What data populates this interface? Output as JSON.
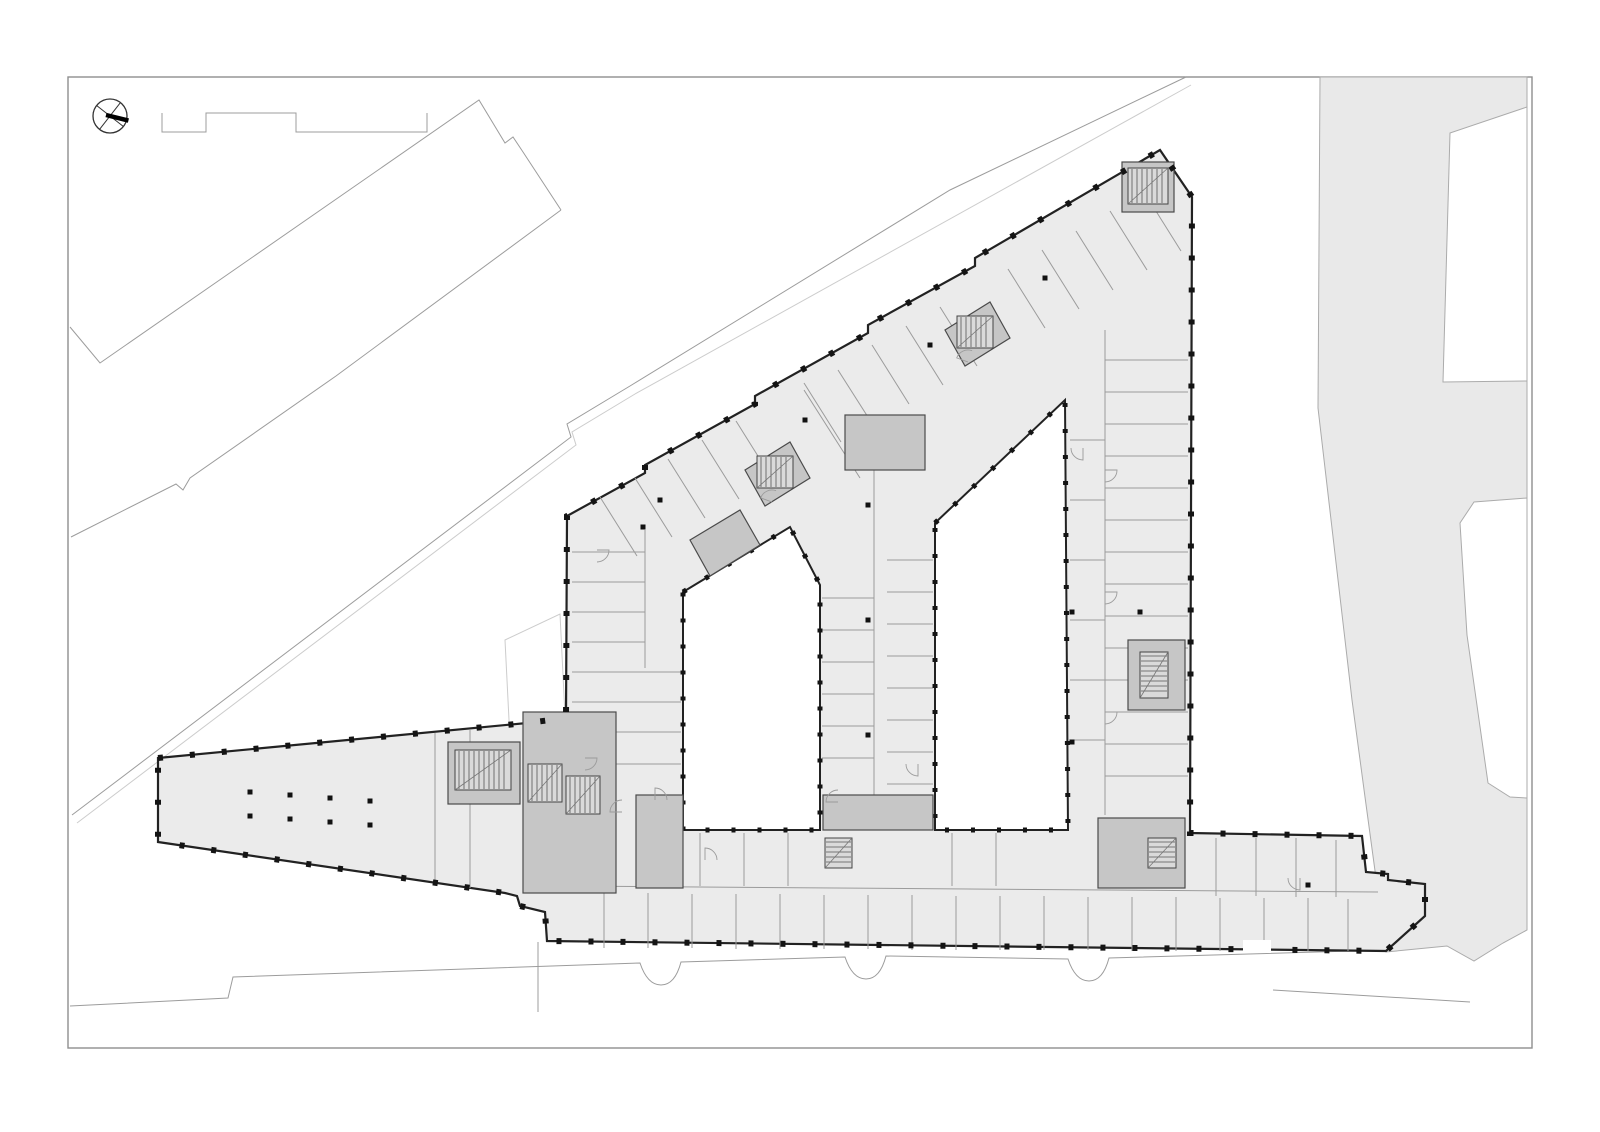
{
  "canvas": {
    "width": 1600,
    "height": 1132,
    "background": "#ffffff"
  },
  "palette": {
    "frame_stroke": "#8f8f8f",
    "street_fill": "#e9e9e9",
    "street_stroke": "#ababab",
    "building_fill": "#ebebeb",
    "building_stroke": "#222222",
    "wall_thin": "#9b9b9b",
    "core_fill": "#c6c6c6",
    "core_stroke": "#4a4a4a",
    "stair_fill": "#dadada",
    "stair_stroke": "#444444",
    "tread_stroke": "#555555",
    "column_fill": "#111111",
    "pier_color": "#141414",
    "site_line": "#9c9c9c",
    "faint_line": "#cccccc",
    "compass_stroke": "#333333",
    "needle_fill": "#000000",
    "courtyard_fill": "#ffffff"
  },
  "frame": {
    "x": 68,
    "y": 77,
    "w": 1464,
    "h": 971
  },
  "compass": {
    "cx": 110,
    "cy": 116,
    "r": 17,
    "cross_angles": [
      38,
      128
    ],
    "needle_angle": 14,
    "needle_width": 4.5
  },
  "street": {
    "polygon": [
      [
        1320,
        77
      ],
      [
        1527,
        77
      ],
      [
        1527,
        930
      ],
      [
        1503,
        943
      ],
      [
        1474,
        961
      ],
      [
        1447,
        946
      ],
      [
        1386,
        952
      ],
      [
        1365,
        797
      ],
      [
        1352,
        700
      ],
      [
        1318,
        408
      ]
    ],
    "cutouts": [
      {
        "name": "street-cutout-upper-block",
        "points": [
          [
            1443,
            382
          ],
          [
            1450,
            133
          ],
          [
            1527,
            107
          ],
          [
            1527,
            381
          ]
        ]
      },
      {
        "name": "street-cutout-lower-block",
        "points": [
          [
            1527,
            498
          ],
          [
            1474,
            502
          ],
          [
            1460,
            523
          ],
          [
            1467,
            635
          ],
          [
            1488,
            783
          ],
          [
            1510,
            797
          ],
          [
            1527,
            798
          ]
        ]
      }
    ]
  },
  "site_lines": [
    {
      "name": "parapet-outline-north",
      "width": 1,
      "points": [
        [
          162,
          113
        ],
        [
          162,
          132
        ],
        [
          206,
          132
        ],
        [
          206,
          113
        ],
        [
          296,
          113
        ],
        [
          296,
          132
        ],
        [
          427,
          132
        ],
        [
          427,
          113
        ]
      ]
    },
    {
      "name": "neighbor-band-nw-edge",
      "width": 1,
      "points": [
        [
          70,
          327
        ],
        [
          100,
          363
        ],
        [
          479,
          100
        ],
        [
          505,
          143
        ],
        [
          513,
          137
        ],
        [
          523,
          152
        ],
        [
          561,
          210
        ]
      ]
    },
    {
      "name": "neighbor-band-se-edge",
      "width": 1,
      "points": [
        [
          561,
          210
        ],
        [
          336,
          376
        ],
        [
          190,
          478
        ],
        [
          183,
          490
        ],
        [
          176,
          484
        ],
        [
          71,
          537
        ]
      ]
    },
    {
      "name": "site-boundary-long",
      "width": 1,
      "points": [
        [
          1186,
          77
        ],
        [
          950,
          190
        ],
        [
          630,
          386
        ],
        [
          567,
          424
        ],
        [
          571,
          437
        ],
        [
          72,
          815
        ]
      ]
    },
    {
      "name": "site-boundary-long-shadow",
      "width": 1,
      "faint": true,
      "points": [
        [
          1191,
          85
        ],
        [
          635,
          394
        ],
        [
          572,
          432
        ],
        [
          576,
          445
        ],
        [
          77,
          823
        ]
      ]
    },
    {
      "name": "canopy-faint-outline",
      "width": 1,
      "faint": true,
      "closed": true,
      "points": [
        [
          505,
          640
        ],
        [
          560,
          614
        ],
        [
          566,
          736
        ],
        [
          511,
          760
        ]
      ]
    },
    {
      "name": "property-line-south",
      "width": 1,
      "points": [
        [
          538,
          942
        ],
        [
          538,
          1012
        ]
      ]
    },
    {
      "name": "curb-segment-southeast",
      "width": 1,
      "points": [
        [
          1273,
          990
        ],
        [
          1470,
          1002
        ]
      ]
    }
  ],
  "curb": {
    "name": "street-curb-south",
    "path": "M 70,1006 L 228,998 L 233,977 L 640,963 C 646,981 654,985 661,985 C 668,985 676,981 681,962 L 845,957 C 851,975 859,979 866,979 C 873,979 881,975 886,956 L 1068,959 C 1074,977 1082,981 1089,981 C 1096,981 1104,977 1109,958 L 1386,950"
  },
  "building": {
    "exterior": [
      [
        158,
        758
      ],
      [
        527,
        723
      ],
      [
        566,
        718
      ],
      [
        567,
        516
      ],
      [
        645,
        473
      ],
      [
        645,
        465
      ],
      [
        755,
        404
      ],
      [
        755,
        396
      ],
      [
        868,
        333
      ],
      [
        868,
        325
      ],
      [
        975,
        266
      ],
      [
        975,
        258
      ],
      [
        1160,
        150
      ],
      [
        1192,
        197
      ],
      [
        1190,
        833
      ],
      [
        1362,
        836
      ],
      [
        1366,
        872
      ],
      [
        1388,
        874
      ],
      [
        1388,
        880
      ],
      [
        1425,
        884
      ],
      [
        1425,
        916
      ],
      [
        1386,
        951
      ],
      [
        547,
        941
      ],
      [
        545,
        912
      ],
      [
        520,
        906
      ],
      [
        517,
        896
      ],
      [
        505,
        893
      ],
      [
        158,
        842
      ]
    ],
    "outline_width": 2.2,
    "pier_dash": {
      "width": 6,
      "dash": "5 27"
    },
    "courtyard_dash": {
      "width": 5,
      "dash": "4 22"
    },
    "courtyards": [
      {
        "name": "courtyard-west",
        "points": [
          [
            683,
            592
          ],
          [
            790,
            527
          ],
          [
            820,
            585
          ],
          [
            820,
            830
          ],
          [
            683,
            830
          ]
        ]
      },
      {
        "name": "courtyard-east",
        "points": [
          [
            935,
            523
          ],
          [
            1065,
            400
          ],
          [
            1068,
            830
          ],
          [
            935,
            830
          ]
        ]
      }
    ],
    "walls": [
      [
        572,
        552,
        645,
        552
      ],
      [
        572,
        582,
        645,
        582
      ],
      [
        572,
        612,
        645,
        612
      ],
      [
        572,
        642,
        645,
        642
      ],
      [
        572,
        672,
        681,
        672
      ],
      [
        572,
        702,
        681,
        702
      ],
      [
        572,
        732,
        681,
        732
      ],
      [
        572,
        764,
        681,
        764
      ],
      [
        645,
        530,
        645,
        668
      ],
      [
        874,
        470,
        874,
        795
      ],
      [
        822,
        598,
        874,
        598
      ],
      [
        822,
        630,
        874,
        630
      ],
      [
        822,
        662,
        874,
        662
      ],
      [
        822,
        694,
        874,
        694
      ],
      [
        822,
        726,
        874,
        726
      ],
      [
        822,
        758,
        874,
        758
      ],
      [
        887,
        560,
        933,
        560
      ],
      [
        887,
        592,
        933,
        592
      ],
      [
        887,
        624,
        933,
        624
      ],
      [
        887,
        656,
        933,
        656
      ],
      [
        887,
        688,
        933,
        688
      ],
      [
        887,
        720,
        933,
        720
      ],
      [
        887,
        752,
        933,
        752
      ],
      [
        887,
        784,
        933,
        784
      ],
      [
        804,
        390,
        860,
        478
      ],
      [
        838,
        370,
        894,
        458
      ],
      [
        1105,
        330,
        1105,
        815
      ],
      [
        1105,
        360,
        1188,
        360
      ],
      [
        1105,
        392,
        1188,
        392
      ],
      [
        1105,
        424,
        1188,
        424
      ],
      [
        1105,
        456,
        1188,
        456
      ],
      [
        1105,
        488,
        1188,
        488
      ],
      [
        1105,
        520,
        1188,
        520
      ],
      [
        1105,
        552,
        1188,
        552
      ],
      [
        1105,
        584,
        1188,
        584
      ],
      [
        1105,
        616,
        1188,
        616
      ],
      [
        1105,
        648,
        1188,
        648
      ],
      [
        1105,
        680,
        1188,
        680
      ],
      [
        1105,
        712,
        1188,
        712
      ],
      [
        1105,
        744,
        1188,
        744
      ],
      [
        1105,
        776,
        1188,
        776
      ],
      [
        1070,
        440,
        1105,
        440
      ],
      [
        1070,
        500,
        1105,
        500
      ],
      [
        1070,
        560,
        1105,
        560
      ],
      [
        1070,
        620,
        1105,
        620
      ],
      [
        1070,
        680,
        1105,
        680
      ],
      [
        1070,
        740,
        1105,
        740
      ],
      [
        560,
        886,
        1378,
        892
      ],
      [
        604,
        893,
        604,
        948
      ],
      [
        648,
        893,
        648,
        948
      ],
      [
        692,
        894,
        692,
        948
      ],
      [
        736,
        894,
        736,
        949
      ],
      [
        780,
        894,
        780,
        949
      ],
      [
        824,
        895,
        824,
        949
      ],
      [
        868,
        895,
        868,
        949
      ],
      [
        912,
        895,
        912,
        950
      ],
      [
        956,
        896,
        956,
        950
      ],
      [
        1000,
        896,
        1000,
        950
      ],
      [
        1044,
        896,
        1044,
        950
      ],
      [
        1088,
        897,
        1088,
        950
      ],
      [
        1132,
        897,
        1132,
        951
      ],
      [
        1176,
        897,
        1176,
        951
      ],
      [
        1220,
        898,
        1220,
        951
      ],
      [
        1264,
        898,
        1264,
        951
      ],
      [
        1308,
        898,
        1308,
        951
      ],
      [
        1348,
        899,
        1348,
        951
      ],
      [
        700,
        833,
        700,
        886
      ],
      [
        744,
        833,
        744,
        886
      ],
      [
        788,
        833,
        788,
        886
      ],
      [
        952,
        833,
        952,
        886
      ],
      [
        996,
        833,
        996,
        886
      ],
      [
        1216,
        838,
        1216,
        896
      ],
      [
        1256,
        838,
        1256,
        896
      ],
      [
        1296,
        838,
        1296,
        897
      ],
      [
        1336,
        840,
        1336,
        897
      ],
      [
        435,
        733,
        435,
        883
      ],
      [
        470,
        730,
        470,
        888
      ],
      [
        523,
        810,
        616,
        810
      ],
      [
        570,
        712,
        570,
        760
      ],
      [
        590,
        812,
        590,
        893
      ],
      [
        600,
        497,
        637,
        556
      ],
      [
        635,
        478,
        672,
        537
      ],
      [
        668,
        459,
        705,
        518
      ],
      [
        702,
        440,
        739,
        499
      ],
      [
        736,
        421,
        773,
        480
      ],
      [
        804,
        383,
        841,
        442
      ],
      [
        872,
        345,
        909,
        404
      ],
      [
        906,
        326,
        943,
        385
      ],
      [
        940,
        307,
        977,
        366
      ],
      [
        1008,
        269,
        1045,
        328
      ],
      [
        1042,
        250,
        1079,
        309
      ],
      [
        1076,
        231,
        1113,
        290
      ],
      [
        1110,
        211,
        1147,
        270
      ],
      [
        1144,
        192,
        1181,
        251
      ]
    ],
    "cores": [
      {
        "name": "core-junction",
        "rect": [
          523,
          712,
          93,
          181
        ]
      },
      {
        "name": "core-left-wing",
        "rect": [
          448,
          742,
          72,
          62
        ]
      },
      {
        "name": "core-westwing-bottom",
        "rect": [
          636,
          795,
          47,
          93
        ]
      },
      {
        "name": "core-midbar-bottom",
        "rect": [
          823,
          795,
          110,
          35
        ]
      },
      {
        "name": "core-midbar-top",
        "rect": [
          845,
          415,
          80,
          55
        ]
      },
      {
        "name": "core-rightwing-bottom",
        "rect": [
          1098,
          818,
          87,
          70
        ]
      },
      {
        "name": "core-rightwing-mid",
        "rect": [
          1128,
          640,
          57,
          70
        ]
      },
      {
        "name": "core-ne-corner",
        "rect": [
          1122,
          162,
          52,
          50
        ]
      },
      {
        "name": "core-diagonal-a",
        "poly": [
          [
            745,
            470
          ],
          [
            790,
            442
          ],
          [
            810,
            478
          ],
          [
            765,
            506
          ]
        ]
      },
      {
        "name": "core-diagonal-b",
        "poly": [
          [
            945,
            330
          ],
          [
            990,
            302
          ],
          [
            1010,
            338
          ],
          [
            965,
            366
          ]
        ]
      },
      {
        "name": "core-diagonal-c",
        "poly": [
          [
            690,
            540
          ],
          [
            740,
            510
          ],
          [
            760,
            545
          ],
          [
            710,
            576
          ]
        ]
      }
    ],
    "stairs": [
      {
        "name": "stair-junction-a",
        "x": 528,
        "y": 764,
        "w": 34,
        "h": 38,
        "dir": "h"
      },
      {
        "name": "stair-junction-b",
        "x": 566,
        "y": 776,
        "w": 34,
        "h": 38,
        "dir": "h"
      },
      {
        "name": "stair-midbar",
        "x": 825,
        "y": 838,
        "w": 27,
        "h": 30,
        "dir": "v"
      },
      {
        "name": "stair-rightwing-south",
        "x": 1148,
        "y": 838,
        "w": 28,
        "h": 30,
        "dir": "v"
      },
      {
        "name": "stair-diagonal-a",
        "x": 757,
        "y": 456,
        "w": 36,
        "h": 32,
        "dir": "h"
      },
      {
        "name": "stair-diagonal-b",
        "x": 957,
        "y": 316,
        "w": 36,
        "h": 32,
        "dir": "h"
      },
      {
        "name": "stair-left-wing",
        "x": 455,
        "y": 750,
        "w": 56,
        "h": 40,
        "dir": "h"
      },
      {
        "name": "stair-rightwing-mid",
        "x": 1140,
        "y": 652,
        "w": 28,
        "h": 46,
        "dir": "v"
      },
      {
        "name": "stair-ne-corner",
        "x": 1128,
        "y": 168,
        "w": 40,
        "h": 36,
        "dir": "h"
      }
    ],
    "columns": [
      [
        250,
        792
      ],
      [
        290,
        795
      ],
      [
        330,
        798
      ],
      [
        370,
        801
      ],
      [
        250,
        816
      ],
      [
        290,
        819
      ],
      [
        330,
        822
      ],
      [
        370,
        825
      ],
      [
        868,
        505
      ],
      [
        868,
        620
      ],
      [
        868,
        735
      ],
      [
        660,
        500
      ],
      [
        805,
        420
      ],
      [
        930,
        345
      ],
      [
        1045,
        278
      ],
      [
        1072,
        612
      ],
      [
        1140,
        612
      ],
      [
        1072,
        742
      ],
      [
        1308,
        885
      ],
      [
        643,
        527
      ]
    ],
    "column_size": 5,
    "doors": [
      {
        "cx": 585,
        "cy": 758,
        "r": 12,
        "a0": 0,
        "a1": 90
      },
      {
        "cx": 622,
        "cy": 812,
        "r": 12,
        "a0": 180,
        "a1": 270
      },
      {
        "cx": 655,
        "cy": 800,
        "r": 12,
        "a0": 270,
        "a1": 360
      },
      {
        "cx": 838,
        "cy": 802,
        "r": 12,
        "a0": 180,
        "a1": 270
      },
      {
        "cx": 918,
        "cy": 764,
        "r": 12,
        "a0": 90,
        "a1": 180
      },
      {
        "cx": 1105,
        "cy": 470,
        "r": 12,
        "a0": 0,
        "a1": 90
      },
      {
        "cx": 1105,
        "cy": 592,
        "r": 12,
        "a0": 0,
        "a1": 90
      },
      {
        "cx": 1105,
        "cy": 712,
        "r": 12,
        "a0": 0,
        "a1": 90
      },
      {
        "cx": 772,
        "cy": 502,
        "r": 12,
        "a0": 200,
        "a1": 290
      },
      {
        "cx": 968,
        "cy": 362,
        "r": 12,
        "a0": 200,
        "a1": 290
      },
      {
        "cx": 1300,
        "cy": 878,
        "r": 12,
        "a0": 90,
        "a1": 180
      },
      {
        "cx": 705,
        "cy": 860,
        "r": 12,
        "a0": 270,
        "a1": 360
      },
      {
        "cx": 597,
        "cy": 550,
        "r": 12,
        "a0": 0,
        "a1": 90
      },
      {
        "cx": 1083,
        "cy": 448,
        "r": 12,
        "a0": 90,
        "a1": 180
      }
    ],
    "entrance_notches": [
      [
        1243,
        940,
        28,
        13
      ]
    ]
  }
}
